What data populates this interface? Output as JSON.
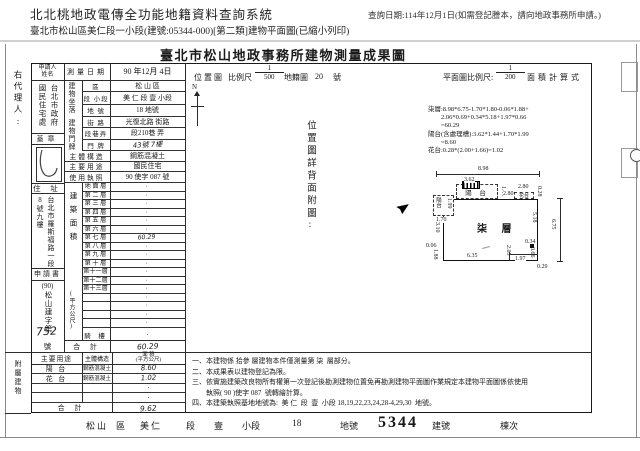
{
  "header": {
    "system_title": "北北桃地政電傳全功能地籍資料查詢系統",
    "query_date": "查詢日期:114年12月1日(如需登記謄本，請向地政事務所申請。)",
    "doc_line": "臺北市松山區美仁段一小段(建號:05344-000)[第二類]建物平面圖(已縮小列印)"
  },
  "sheet": {
    "agent_label": "右代理人:",
    "title": "臺北市松山地政事務所建物測量成果圖",
    "applicant_label_1": "申請人",
    "applicant_label_2": "姓名",
    "applicant_name_right": "台北市政府",
    "applicant_name_left": "國民住宅處",
    "seal_label": "蓋章",
    "survey_date_label": "測量日期",
    "survey_date_value": "90 年12月 4日",
    "site_label": "建物坐落",
    "site_rows": [
      {
        "label": "區",
        "value": "松 山 區"
      },
      {
        "label": "段 小段",
        "value": "美 仁 段 壹 小段"
      },
      {
        "label": "地 號",
        "value": "18 地號"
      }
    ],
    "door_label": "建物門牌",
    "door_rows": [
      {
        "label": "街 路",
        "value": "光復北路 街路"
      },
      {
        "label": "段巷弄",
        "value": "段210巷 弄"
      },
      {
        "label": "門 牌",
        "value": "43號 7樓",
        "hand": true
      }
    ],
    "info_rows": [
      {
        "label": "主體構造",
        "value": "鋼筋混凝土"
      },
      {
        "label": "主要用途",
        "value": "國民住宅"
      },
      {
        "label": "使用執照",
        "value": "90 使字 087 號"
      }
    ],
    "residence_label": "住 址",
    "residence_right": "台北市羅斯福路一段",
    "residence_left": "8號九樓",
    "application_label": "申請書",
    "application_prefix": "(90)",
    "application_body": "松山建字第",
    "application_no": "752",
    "application_suffix": "號",
    "area_label": "建築面積",
    "area_unit": "(平方公尺)",
    "floor_rows": [
      {
        "label": "地 面 層",
        "value": "·"
      },
      {
        "label": "第 二 層",
        "value": "·"
      },
      {
        "label": "第 三 層",
        "value": "·"
      },
      {
        "label": "第 四 層",
        "value": "·"
      },
      {
        "label": "第 五 層",
        "value": "·"
      },
      {
        "label": "第 六 層",
        "value": "·"
      },
      {
        "label": "第 七 層",
        "value": "60.29",
        "hand": true
      },
      {
        "label": "第 八 層",
        "value": "·"
      },
      {
        "label": "第 九 層",
        "value": "·"
      },
      {
        "label": "第 十 層",
        "value": "·"
      },
      {
        "label": "第十一層",
        "value": "·"
      },
      {
        "label": "第十二層",
        "value": "·"
      },
      {
        "label": "第十三層",
        "value": "·"
      },
      {
        "label": "",
        "value": "·"
      },
      {
        "label": "",
        "value": "·"
      },
      {
        "label": "",
        "value": "·"
      },
      {
        "label": "",
        "value": "·"
      }
    ],
    "arcade_label": "騎 樓",
    "arcade_value": "·",
    "area_total_label": "合 計",
    "area_total_value": "60.29",
    "annex": {
      "label": "附屬建物",
      "h_use": "主要用途",
      "h_struct": "主體構造",
      "h_area1": "面 積",
      "h_area2": "(平方公尺)",
      "rows": [
        {
          "use": "陽 台",
          "struct": "鋼筋混凝土",
          "area": "8.60",
          "hand": true
        },
        {
          "use": "花 台",
          "struct": "鋼筋混凝土",
          "area": "1.02",
          "hand": true
        },
        {
          "use": "",
          "struct": "",
          "area": "·"
        },
        {
          "use": "",
          "struct": "",
          "area": "·"
        }
      ],
      "total_label": "合 計",
      "total_value": "9.62"
    },
    "location": {
      "label": "位置圖",
      "scale_label": "比例尺",
      "num": "1",
      "den": "500",
      "map_label": "地籍圖",
      "map_no": "20",
      "no_suffix": "號",
      "north": "N",
      "back_note": "位置圖詳背面附圖:"
    },
    "plan": {
      "scale_label": "平面圖比例尺:",
      "num": "1",
      "den": "200",
      "calc_label": "面積計算式",
      "calc_lines": [
        "柒層:8.98*6.75-1.70*1.80-0.06*1.88+",
        "　　2.06*0.69+0.34*5.18+1.97*0.66",
        "　　=60.29",
        "陽台(含處理槽):3.62*1.44+1.70*1.99",
        "　　=8.60",
        "花台:0.28*(2.00+1.66)=1.02"
      ],
      "room": "柒 層",
      "balcony_top": "陽 台",
      "balcony_left": "陽台",
      "flower": "花台",
      "dims": {
        "top": "8.98",
        "balc_w": "3.62",
        "balc_h": "1.44",
        "gap_a": "2.80",
        "gap_b": "2.80",
        "flower_d": "0.28",
        "lb_h": "1.99",
        "lb_w": "1.70",
        "left_up": "3.10",
        "left_step": "0.06",
        "left_low": "1.88",
        "bottom": "6.35",
        "inner": "2.05",
        "br": "1.97",
        "step": "0.66",
        "small": "0.34",
        "right_in": "5.18",
        "right_all": "6.75",
        "corner": "0.29"
      }
    },
    "notes": [
      "一、本建物係 拾參 層建物本件僅測量第 柒  層部分。",
      "二、本成果表以建物登記為限。",
      "三、依實施建築改良物所有權第一次登記後勘測建物位置免再勘測建物平面圖作業規定本建物平面圖係依使用",
      "　　執照( 90 )使字 087  號轉繪計算。",
      "四、本建築執照基地地號為:  美 仁  段  壹  小段 18,19,22,23,24,28-4,29,30  地號。"
    ],
    "footer": {
      "district": "松山",
      "district_u": "區",
      "section": "美仁",
      "section_u": "段",
      "sub": "壹",
      "sub_u": "小段",
      "land": "18",
      "land_u": "地號",
      "bno": "5344",
      "bno_u": "建號",
      "unit_u": "棟次"
    }
  }
}
